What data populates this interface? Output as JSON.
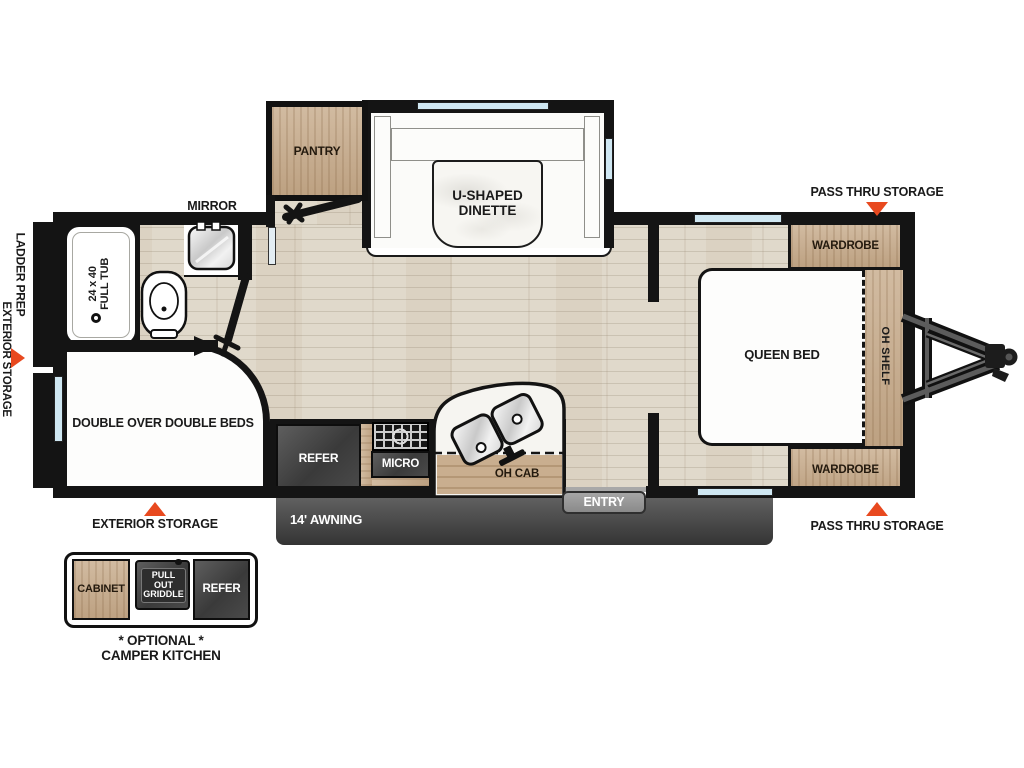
{
  "labels": {
    "mirror": "MIRROR",
    "pantry": "PANTRY",
    "dinette1": "U-SHAPED",
    "dinette2": "DINETTE",
    "tub1": "24 x 40",
    "tub2": "FULL TUB",
    "double_beds": "DOUBLE OVER DOUBLE BEDS",
    "refer": "REFER",
    "micro": "MICRO",
    "oh_cab": "OH CAB",
    "queen_bed": "QUEEN BED",
    "oh_shelf": "OH SHELF",
    "wardrobe_top": "WARDROBE",
    "wardrobe_bottom": "WARDROBE"
  },
  "exterior": {
    "ladder_prep": "LADDER PREP",
    "exterior_storage_left": "EXTERIOR STORAGE",
    "exterior_storage_bottom": "EXTERIOR STORAGE",
    "pass_thru_top": "PASS THRU STORAGE",
    "pass_thru_bottom": "PASS THRU STORAGE",
    "awning": "14' AWNING",
    "entry": "ENTRY"
  },
  "camper_kitchen": {
    "cabinet": "CABINET",
    "griddle1": "PULL OUT",
    "griddle2": "GRIDDLE",
    "refer": "REFER",
    "optional": "* OPTIONAL *",
    "title": "CAMPER KITCHEN"
  },
  "colors": {
    "accent_red": "#e8491f",
    "cabinet_wood": "#c9ae8f",
    "floor_wood": "#e0d9cb",
    "equipment_dark": "#464646",
    "window_blue": "#cfe7f2"
  }
}
